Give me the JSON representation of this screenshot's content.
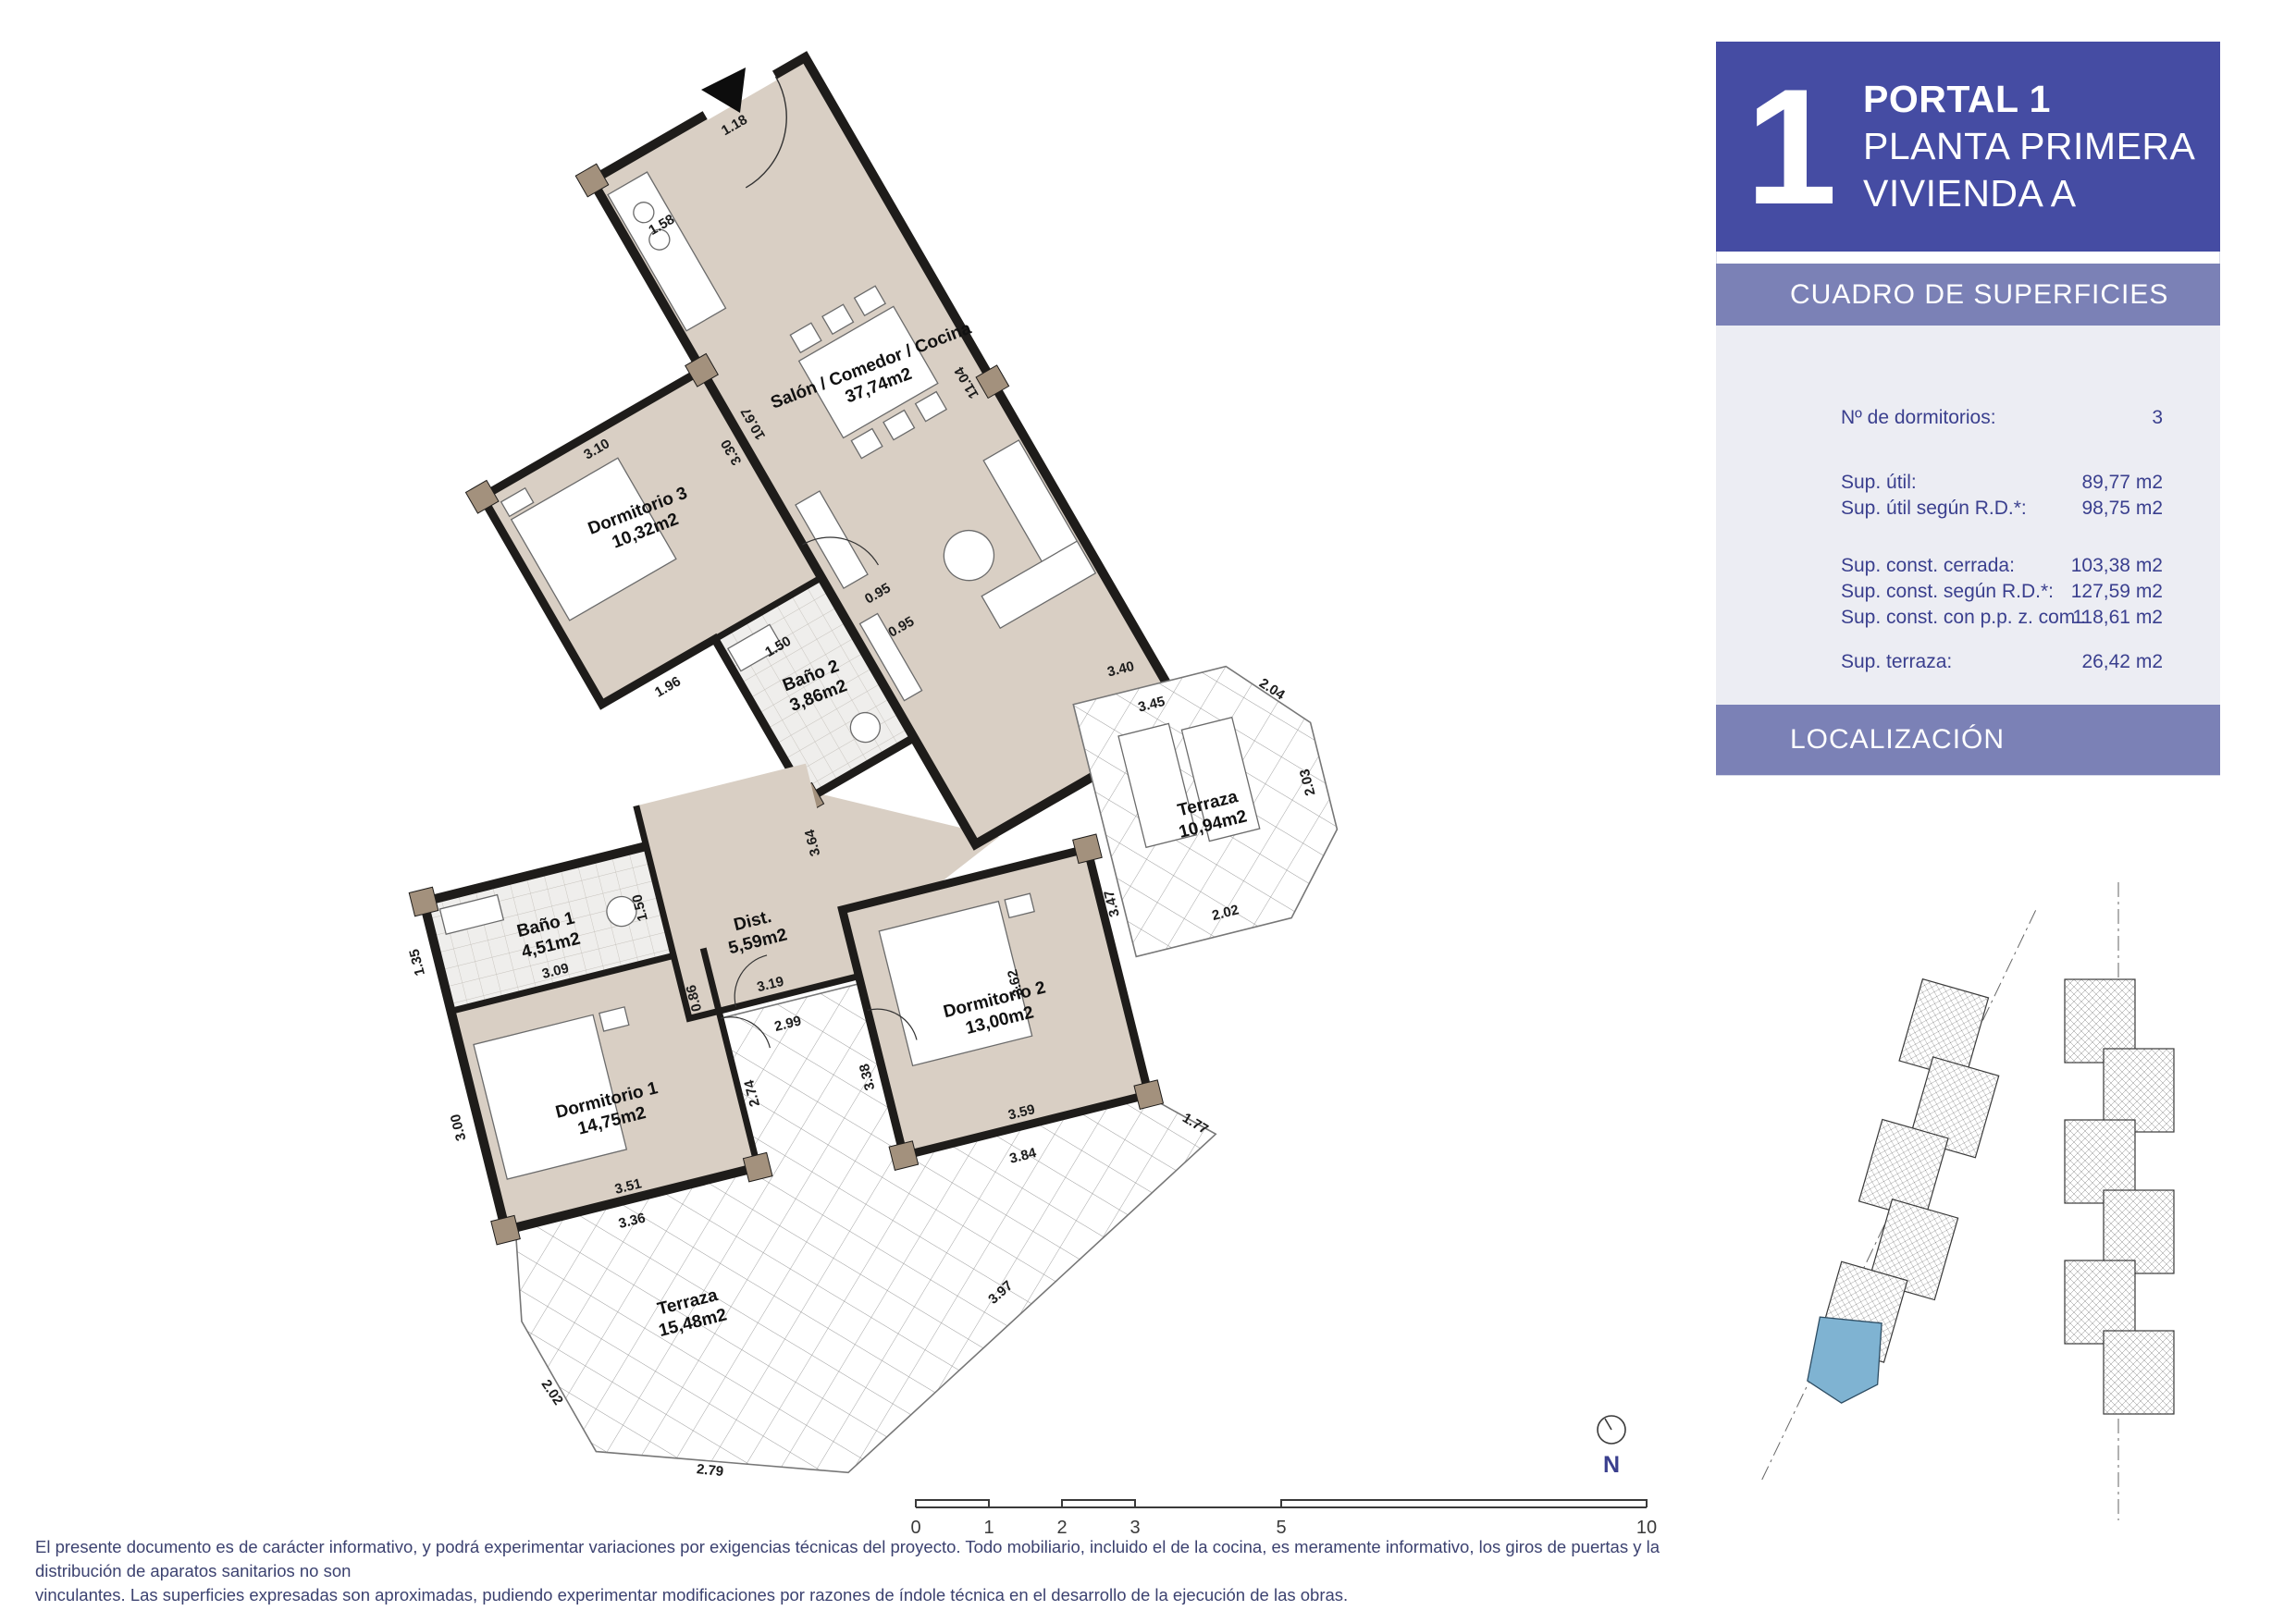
{
  "header": {
    "unit_number": "1",
    "line1": "PORTAL 1",
    "line2": "PLANTA PRIMERA",
    "line3": "VIVIENDA A"
  },
  "surfaces": {
    "title": "CUADRO DE SUPERFICIES",
    "rows": [
      {
        "label": "Nº de dormitorios:",
        "value": "3"
      },
      {
        "label": "Sup. útil:",
        "value": "89,77 m2"
      },
      {
        "label": "Sup. útil según R.D.*:",
        "value": "98,75 m2"
      },
      {
        "label": "Sup. const. cerrada:",
        "value": "103,38 m2"
      },
      {
        "label": "Sup. const. según R.D.*:",
        "value": "127,59 m2"
      },
      {
        "label": "Sup. const. con p.p. z. com.:",
        "value": "118,61 m2"
      },
      {
        "label": "Sup. terraza:",
        "value": "26,42 m2"
      }
    ]
  },
  "localization": {
    "title": "LOCALIZACIÓN"
  },
  "plan": {
    "rooms": [
      {
        "name": "Dormitorio 3",
        "area": "10,32m2"
      },
      {
        "name": "Salón / Comedor / Cocina",
        "area": "37,74m2"
      },
      {
        "name": "Baño 2",
        "area": "3,86m2"
      },
      {
        "name": "Baño 1",
        "area": "4,51m2"
      },
      {
        "name": "Dist.",
        "area": "5,59m2"
      },
      {
        "name": "Dormitorio 1",
        "area": "14,75m2"
      },
      {
        "name": "Dormitorio 2",
        "area": "13,00m2"
      },
      {
        "name": "Terraza",
        "area": "10,94m2"
      },
      {
        "name": "Terraza",
        "area": "15,48m2"
      }
    ],
    "dims": [
      "1.18",
      "1.58",
      "11.04",
      "3.10",
      "10.67",
      "3.30",
      "0.95",
      "0.95",
      "1.96",
      "1.50",
      "1.50",
      "1.35",
      "3.09",
      "3.00",
      "3.51",
      "0.86",
      "3.19",
      "2.99",
      "3.64",
      "3.38",
      "3.62",
      "3.59",
      "3.84",
      "1.77",
      "3.97",
      "2.79",
      "2.02",
      "2.74",
      "3.36",
      "3.40",
      "3.45",
      "2.04",
      "2.03",
      "2.02",
      "3.47"
    ],
    "scale_ticks": [
      "0",
      "1",
      "2",
      "3",
      "5",
      "10"
    ],
    "north_label": "N"
  },
  "footer": {
    "line1": "El presente documento es de carácter informativo, y podrá experimentar variaciones por exigencias técnicas del proyecto. Todo mobiliario, incluido el de la cocina, es meramente informativo, los giros de puertas y la distribución de aparatos sanitarios no son",
    "line2": "vinculantes. Las superficies expresadas son aproximadas, pudiendo experimentar modificaciones por razones de índole técnica en el desarrollo de la ejecución de las obras."
  },
  "colors": {
    "header_blue": "#454ca3",
    "section_bar": "#7b81b6",
    "panel_light": "#ecedf3",
    "navy_text": "#3a3f8e",
    "floor_beige": "#d9cfc4",
    "wall_black": "#1e1c1a",
    "column_tan": "#a3917d",
    "highlight_unit_blue": "#7fb3d2"
  }
}
